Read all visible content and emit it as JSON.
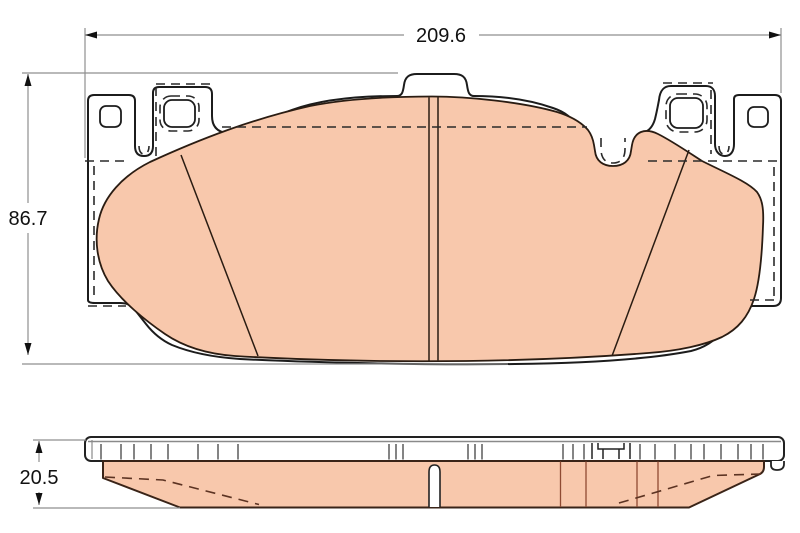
{
  "drawing": {
    "type": "technical-drawing",
    "subject": "disc-brake-pad",
    "background": "#ffffff",
    "colors": {
      "outline": "#1c1c1c",
      "friction_fill": "#f8c8ac",
      "friction_edge": "#42281a",
      "hidden_line": "#2a2a2a",
      "dimension_line": "#8f8f8f",
      "text": "#111111"
    },
    "views": {
      "front": {
        "id": "front-view"
      },
      "side": {
        "id": "side-profile-view"
      }
    },
    "dims": {
      "width": {
        "value": "209.6",
        "orientation": "horizontal",
        "view": "front"
      },
      "height": {
        "value": "86.7",
        "orientation": "vertical",
        "view": "front"
      },
      "thickness": {
        "value": "20.5",
        "orientation": "vertical",
        "view": "side"
      }
    }
  }
}
